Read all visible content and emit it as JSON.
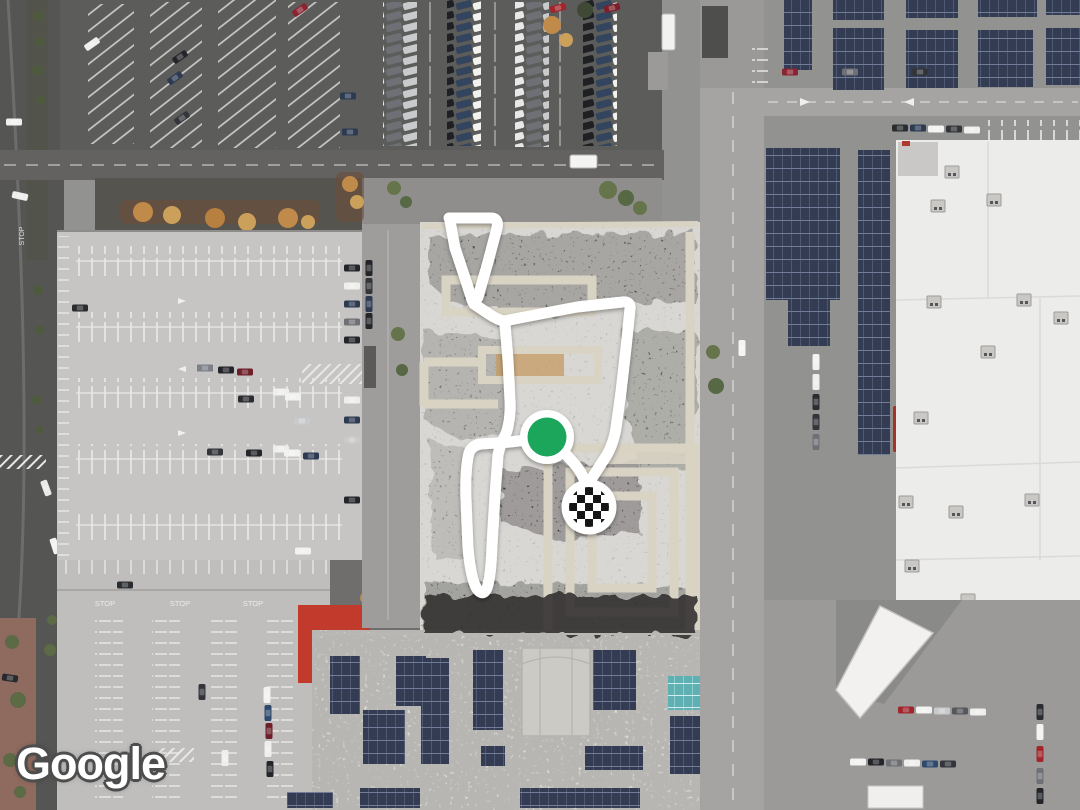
{
  "map": {
    "watermark": "Google",
    "pavement_text": {
      "stop": "STOP"
    },
    "route": {
      "color": "#ffffff",
      "start_marker": {
        "name": "route-start",
        "shape": "green-dot",
        "color": "#1fa65b"
      },
      "end_marker": {
        "name": "route-end",
        "shape": "checkered-flag"
      }
    },
    "palette": {
      "asphalt_dark": "#5b5b59",
      "asphalt_light": "#a5a4a2",
      "parking_deck": "#c6c5c3",
      "white_roof": "#ececea",
      "solar_panel": "#333c52",
      "teal_panel": "#5fb0b2",
      "tree_green": "#66744c",
      "tree_autumn": "#bf8a4a",
      "awning_red": "#c23a2c"
    }
  }
}
